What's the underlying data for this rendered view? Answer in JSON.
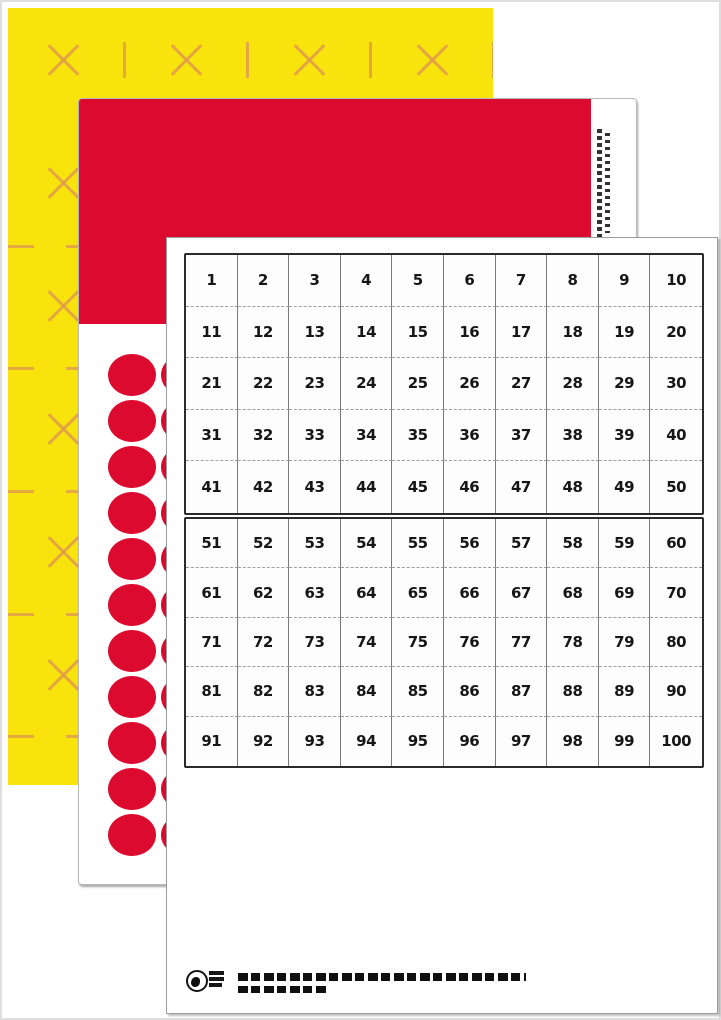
{
  "photo": {
    "description_note": "",
    "colors": {
      "yellow": "#F8E40C",
      "cut_mark": "#E09A4E",
      "red": "#DC0A2E",
      "paper": "#FFFFFF",
      "grid_border": "#2B2B2B",
      "grid_line": "#7A7A7A",
      "grid_dash": "#9E9E9E",
      "number": "#161616"
    },
    "front_sheet": {
      "hundred_chart": {
        "rows": [
          [
            1,
            2,
            3,
            4,
            5,
            6,
            7,
            8,
            9,
            10
          ],
          [
            11,
            12,
            13,
            14,
            15,
            16,
            17,
            18,
            19,
            20
          ],
          [
            21,
            22,
            23,
            24,
            25,
            26,
            27,
            28,
            29,
            30
          ],
          [
            31,
            32,
            33,
            34,
            35,
            36,
            37,
            38,
            39,
            40
          ],
          [
            41,
            42,
            43,
            44,
            45,
            46,
            47,
            48,
            49,
            50
          ],
          [
            51,
            52,
            53,
            54,
            55,
            56,
            57,
            58,
            59,
            60
          ],
          [
            61,
            62,
            63,
            64,
            65,
            66,
            67,
            68,
            69,
            70
          ],
          [
            71,
            72,
            73,
            74,
            75,
            76,
            77,
            78,
            79,
            80
          ],
          [
            81,
            82,
            83,
            84,
            85,
            86,
            87,
            88,
            89,
            90
          ],
          [
            91,
            92,
            93,
            94,
            95,
            96,
            97,
            98,
            99,
            100
          ]
        ]
      }
    },
    "middle_sheet": {
      "dot_stickers": {
        "visible_columns": 2,
        "rows": 11
      }
    }
  }
}
